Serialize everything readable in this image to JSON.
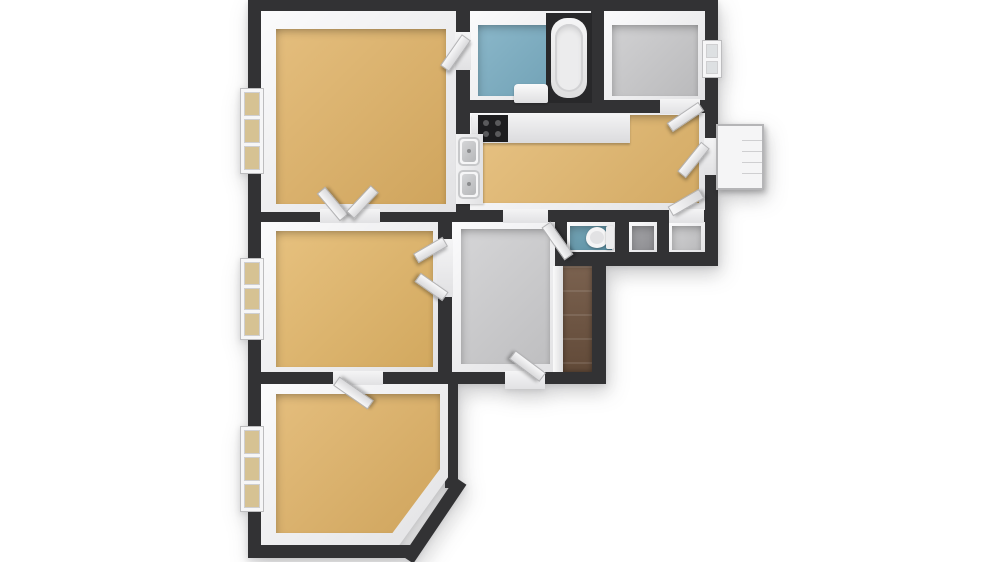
{
  "scene": {
    "type": "3d-floorplan-top-down-render",
    "background": "#ffffff",
    "no_visible_text": true
  },
  "colors": {
    "wall": "#323234",
    "wall_face": "#f1f1f2",
    "floor_wood": "#dfb164",
    "floor_wood_mid": "#e3b76c",
    "floor_wood_low": "#e2b566",
    "floor_bath": "#74a9bf",
    "floor_wc": "#5d96ab",
    "floor_gray": "#c8c8ca",
    "floor_hall": "#cdcdcf",
    "floor_gray_dark": "#96969a",
    "floor_plank": "#6f5440",
    "tub_surround": "#28282a",
    "fixture_white": "#f2f2f3",
    "pane_tint": "#d6c293",
    "pane_gray": "#dde0e2",
    "cooktop": "#1d1d1f"
  },
  "rooms": [
    {
      "id": "living-room",
      "floor": "wood-tan",
      "windows": 1,
      "doors": [
        "to-middle-bedroom-double",
        "to-bathroom"
      ]
    },
    {
      "id": "bathroom",
      "floor": "blue-tile",
      "fixtures": [
        "bathtub",
        "wash-basin"
      ]
    },
    {
      "id": "utility-room-top-right",
      "floor": "gray",
      "windows": 1,
      "doors": [
        "to-kitchen"
      ]
    },
    {
      "id": "kitchen-dining",
      "floor": "wood-tan",
      "fixtures": [
        "counter",
        "cooktop",
        "double-sink"
      ],
      "doors": [
        "to-hallway",
        "to-balcony",
        "to-right-closet"
      ]
    },
    {
      "id": "hallway",
      "floor": "gray",
      "doors": [
        "entry-door-bottom",
        "to-middle-bedroom-double",
        "to-wc"
      ]
    },
    {
      "id": "middle-bedroom",
      "floor": "wood-tan",
      "windows": 1
    },
    {
      "id": "wc",
      "floor": "teal-tile",
      "fixtures": [
        "toilet"
      ]
    },
    {
      "id": "closet-small",
      "floor": "gray-dark"
    },
    {
      "id": "closet-right",
      "floor": "gray"
    },
    {
      "id": "wardrobe-nook",
      "floor": "dark-wood-planks"
    },
    {
      "id": "bottom-bedroom",
      "floor": "wood-tan",
      "windows": 1,
      "shape": "chamfered-bottom-right-corner"
    }
  ],
  "exterior": {
    "balcony_landing": {
      "position": "right-of-kitchen",
      "style": "white box with step lines"
    }
  },
  "counts": {
    "windows": 4,
    "door_leaves": 10,
    "sinks": 2,
    "bathtubs": 1,
    "toilets": 1
  }
}
